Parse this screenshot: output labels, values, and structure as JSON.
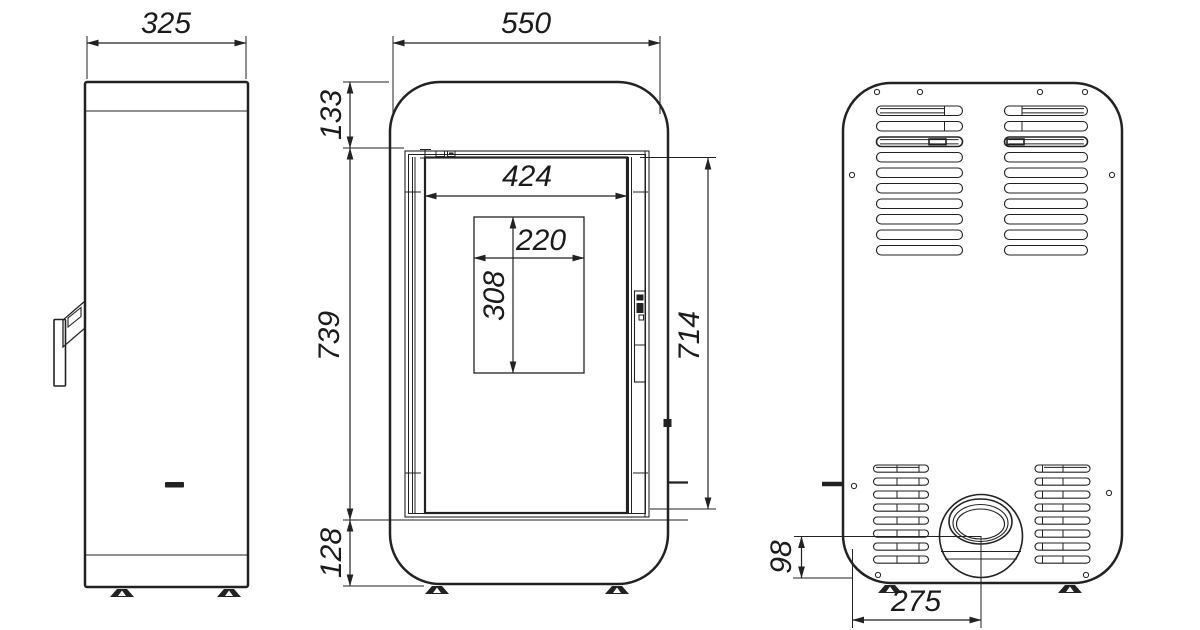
{
  "drawing": {
    "dimensions_mm": {
      "side_width": "325",
      "front_width": "550",
      "top_section_height": "133",
      "door_section_height": "739",
      "base_section_height": "128",
      "door_inner_width": "424",
      "glass_width": "220",
      "glass_height": "308",
      "door_total_height": "714",
      "flue_center_to_base": "98",
      "flue_center_offset": "275"
    },
    "colors": {
      "line": "#222222",
      "background": "#ffffff"
    }
  }
}
